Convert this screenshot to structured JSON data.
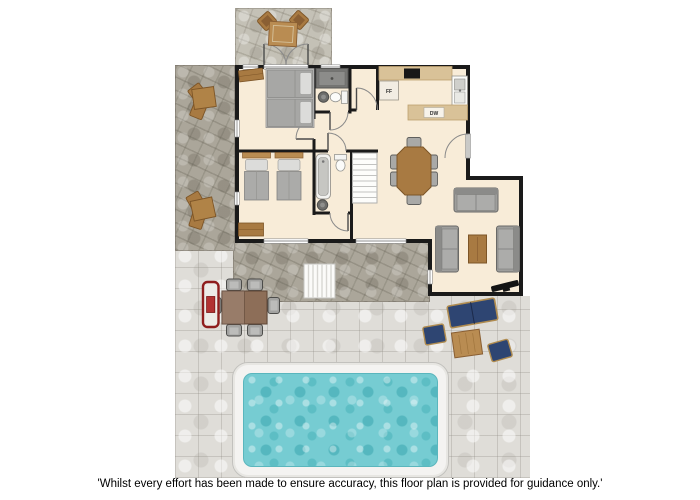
{
  "disclaimer": "'Whilst every effort has been made to ensure accuracy, this floor plan is provided for guidance only.'",
  "labels": {
    "fridge_freezer": "FF",
    "dishwasher": "DW"
  },
  "colors": {
    "wall": "#1a1a1a",
    "floor": "#f8ecd8",
    "counter": "#d9c298",
    "wood": "#a87a42",
    "wood-dark": "#7d5527",
    "wood-light": "#b98c52",
    "sofa-grey": "#9e9e9c",
    "mattress": "#a7a7a5",
    "navy": "#2e4572",
    "navy-frame": "#b08c50",
    "bbq-red": "#8f1d1d",
    "patio-dark": "#aba69a",
    "patio-light": "#dfddd8",
    "terrace": "#c4c1b6",
    "pool-water": "#76ccd2",
    "pool-deck": "#f4f3f1"
  }
}
